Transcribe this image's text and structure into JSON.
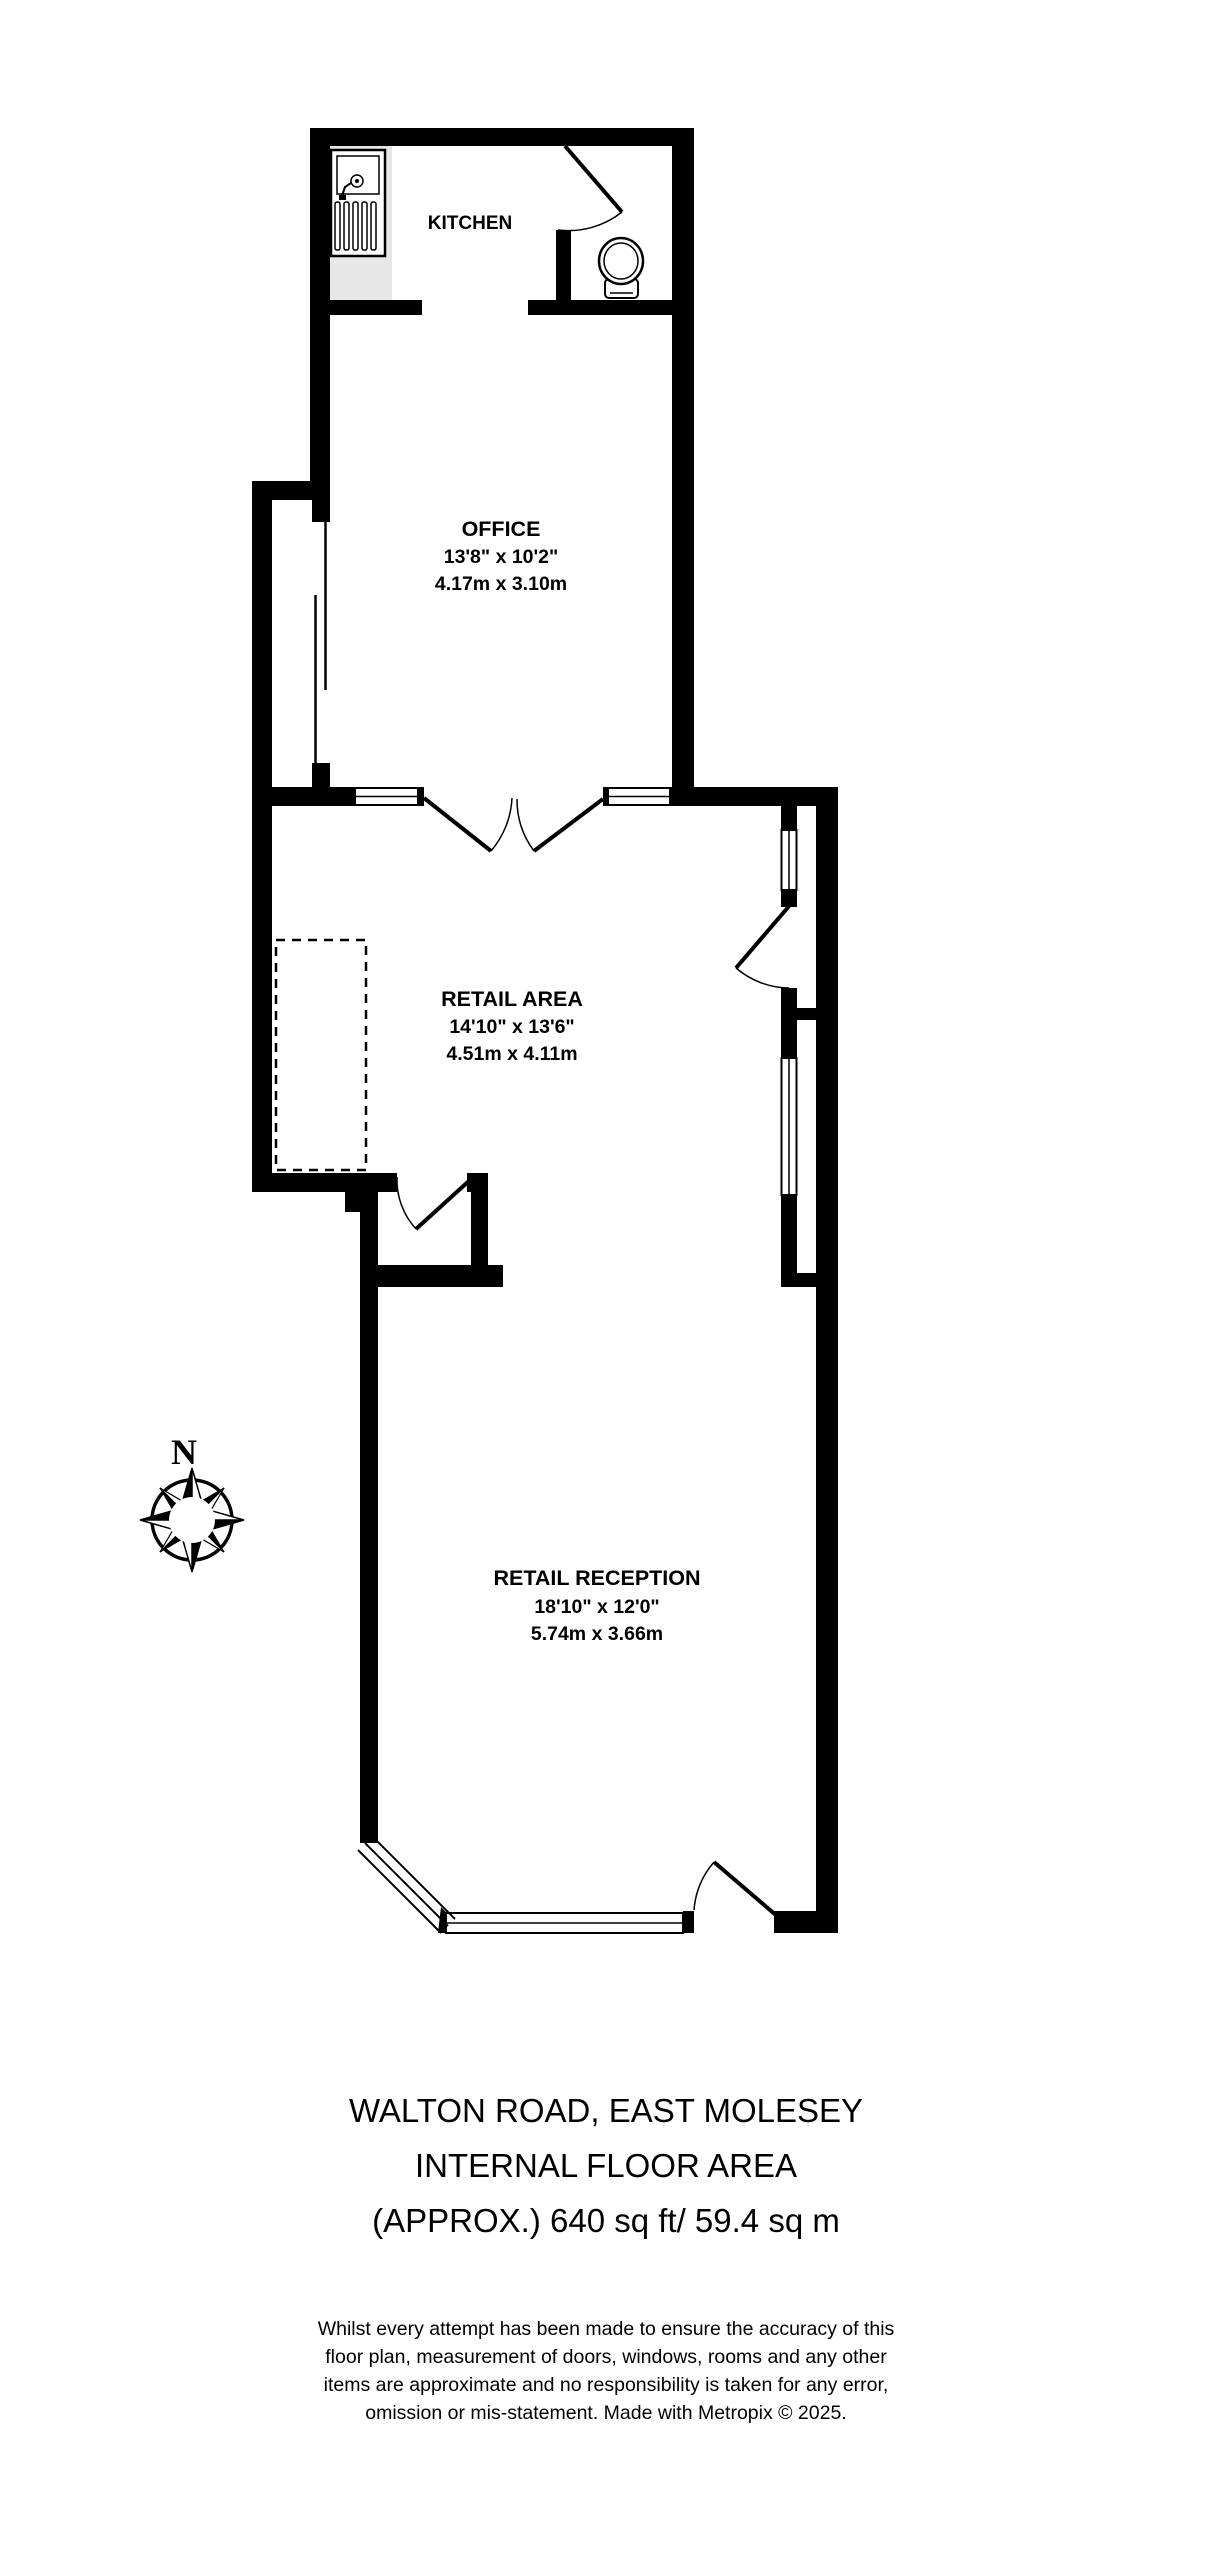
{
  "colors": {
    "wall": "#000000",
    "counter_fill": "#e7e7e7",
    "background": "#ffffff",
    "text": "#000000"
  },
  "plan": {
    "compass": {
      "label": "N"
    },
    "rooms": [
      {
        "name": "KITCHEN"
      },
      {
        "name": "OFFICE",
        "imperial": "13'8\"  x 10'2\"",
        "metric": "4.17m  x 3.10m"
      },
      {
        "name": "RETAIL AREA",
        "imperial": "14'10\"  x 13'6\"",
        "metric": "4.51m  x 4.11m"
      },
      {
        "name": "RETAIL RECEPTION",
        "imperial": "18'10\"  x 12'0\"",
        "metric": "5.74m  x 3.66m"
      }
    ],
    "fixtures": [
      {
        "icon": "sink-icon"
      },
      {
        "icon": "toilet-icon"
      },
      {
        "icon": "compass-rose-icon"
      }
    ]
  },
  "footer": {
    "title_lines": [
      "WALTON ROAD, EAST MOLESEY",
      "INTERNAL FLOOR AREA",
      "(APPROX.) 640 sq ft/ 59.4 sq m"
    ],
    "disclaimer_lines": [
      "Whilst every attempt has been made to ensure the accuracy of this",
      "floor plan, measurement of doors, windows, rooms and any other",
      "items are approximate and no responsibility is taken for any error,",
      "omission or mis-statement. Made with Metropix © 2025."
    ]
  }
}
